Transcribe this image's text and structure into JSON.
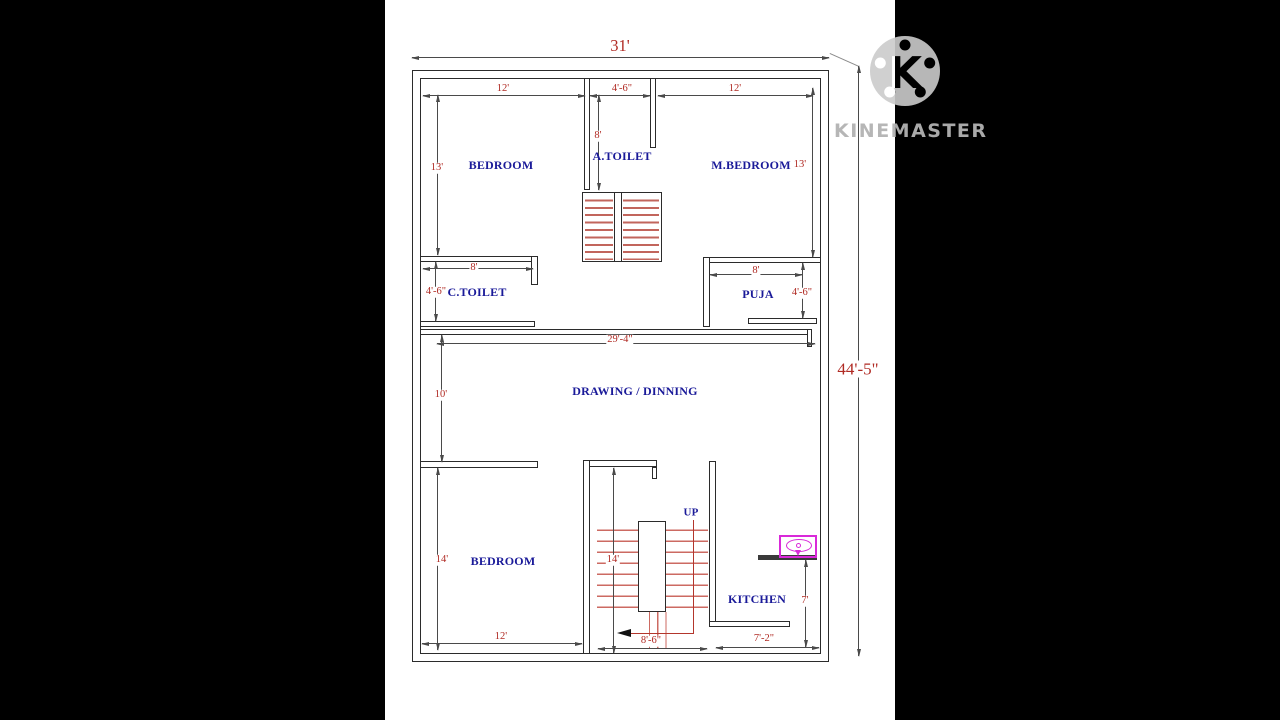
{
  "watermark": {
    "brand": "KINEMASTER"
  },
  "plan": {
    "overall_width": "31'",
    "overall_height": "44'-5\"",
    "rooms": {
      "bedroom_top": "BEDROOM",
      "a_toilet": "A.TOILET",
      "m_bedroom": "M.BEDROOM",
      "c_toilet": "C.TOILET",
      "puja": "PUJA",
      "drawing_dining": "DRAWING / DINNING",
      "bedroom_bottom": "BEDROOM",
      "kitchen": "KITCHEN",
      "up": "UP"
    },
    "dims": {
      "bedroom_top_w": "12'",
      "bedroom_top_h": "13'",
      "a_toilet_w": "4'-6\"",
      "a_toilet_h": "8'",
      "m_bedroom_w": "12'",
      "m_bedroom_h": "13'",
      "c_toilet_w": "8'",
      "c_toilet_h": "4'-6\"",
      "puja_w": "8'",
      "puja_h": "4'-6\"",
      "drawing_w": "29'-4\"",
      "drawing_h": "10'",
      "bedroom_bottom_h": "14'",
      "bedroom_bottom_w": "12'",
      "stairs_h": "14'",
      "stairs_w": "8'-6\"",
      "kitchen_h": "7'",
      "kitchen_w": "7'-2\""
    },
    "colors": {
      "dim_text": "#b02a23",
      "room_text": "#1a1a99",
      "stair_tread": "#c2655c",
      "sink_fixture": "#d929d9",
      "wall_line": "#2b2b2b"
    }
  }
}
